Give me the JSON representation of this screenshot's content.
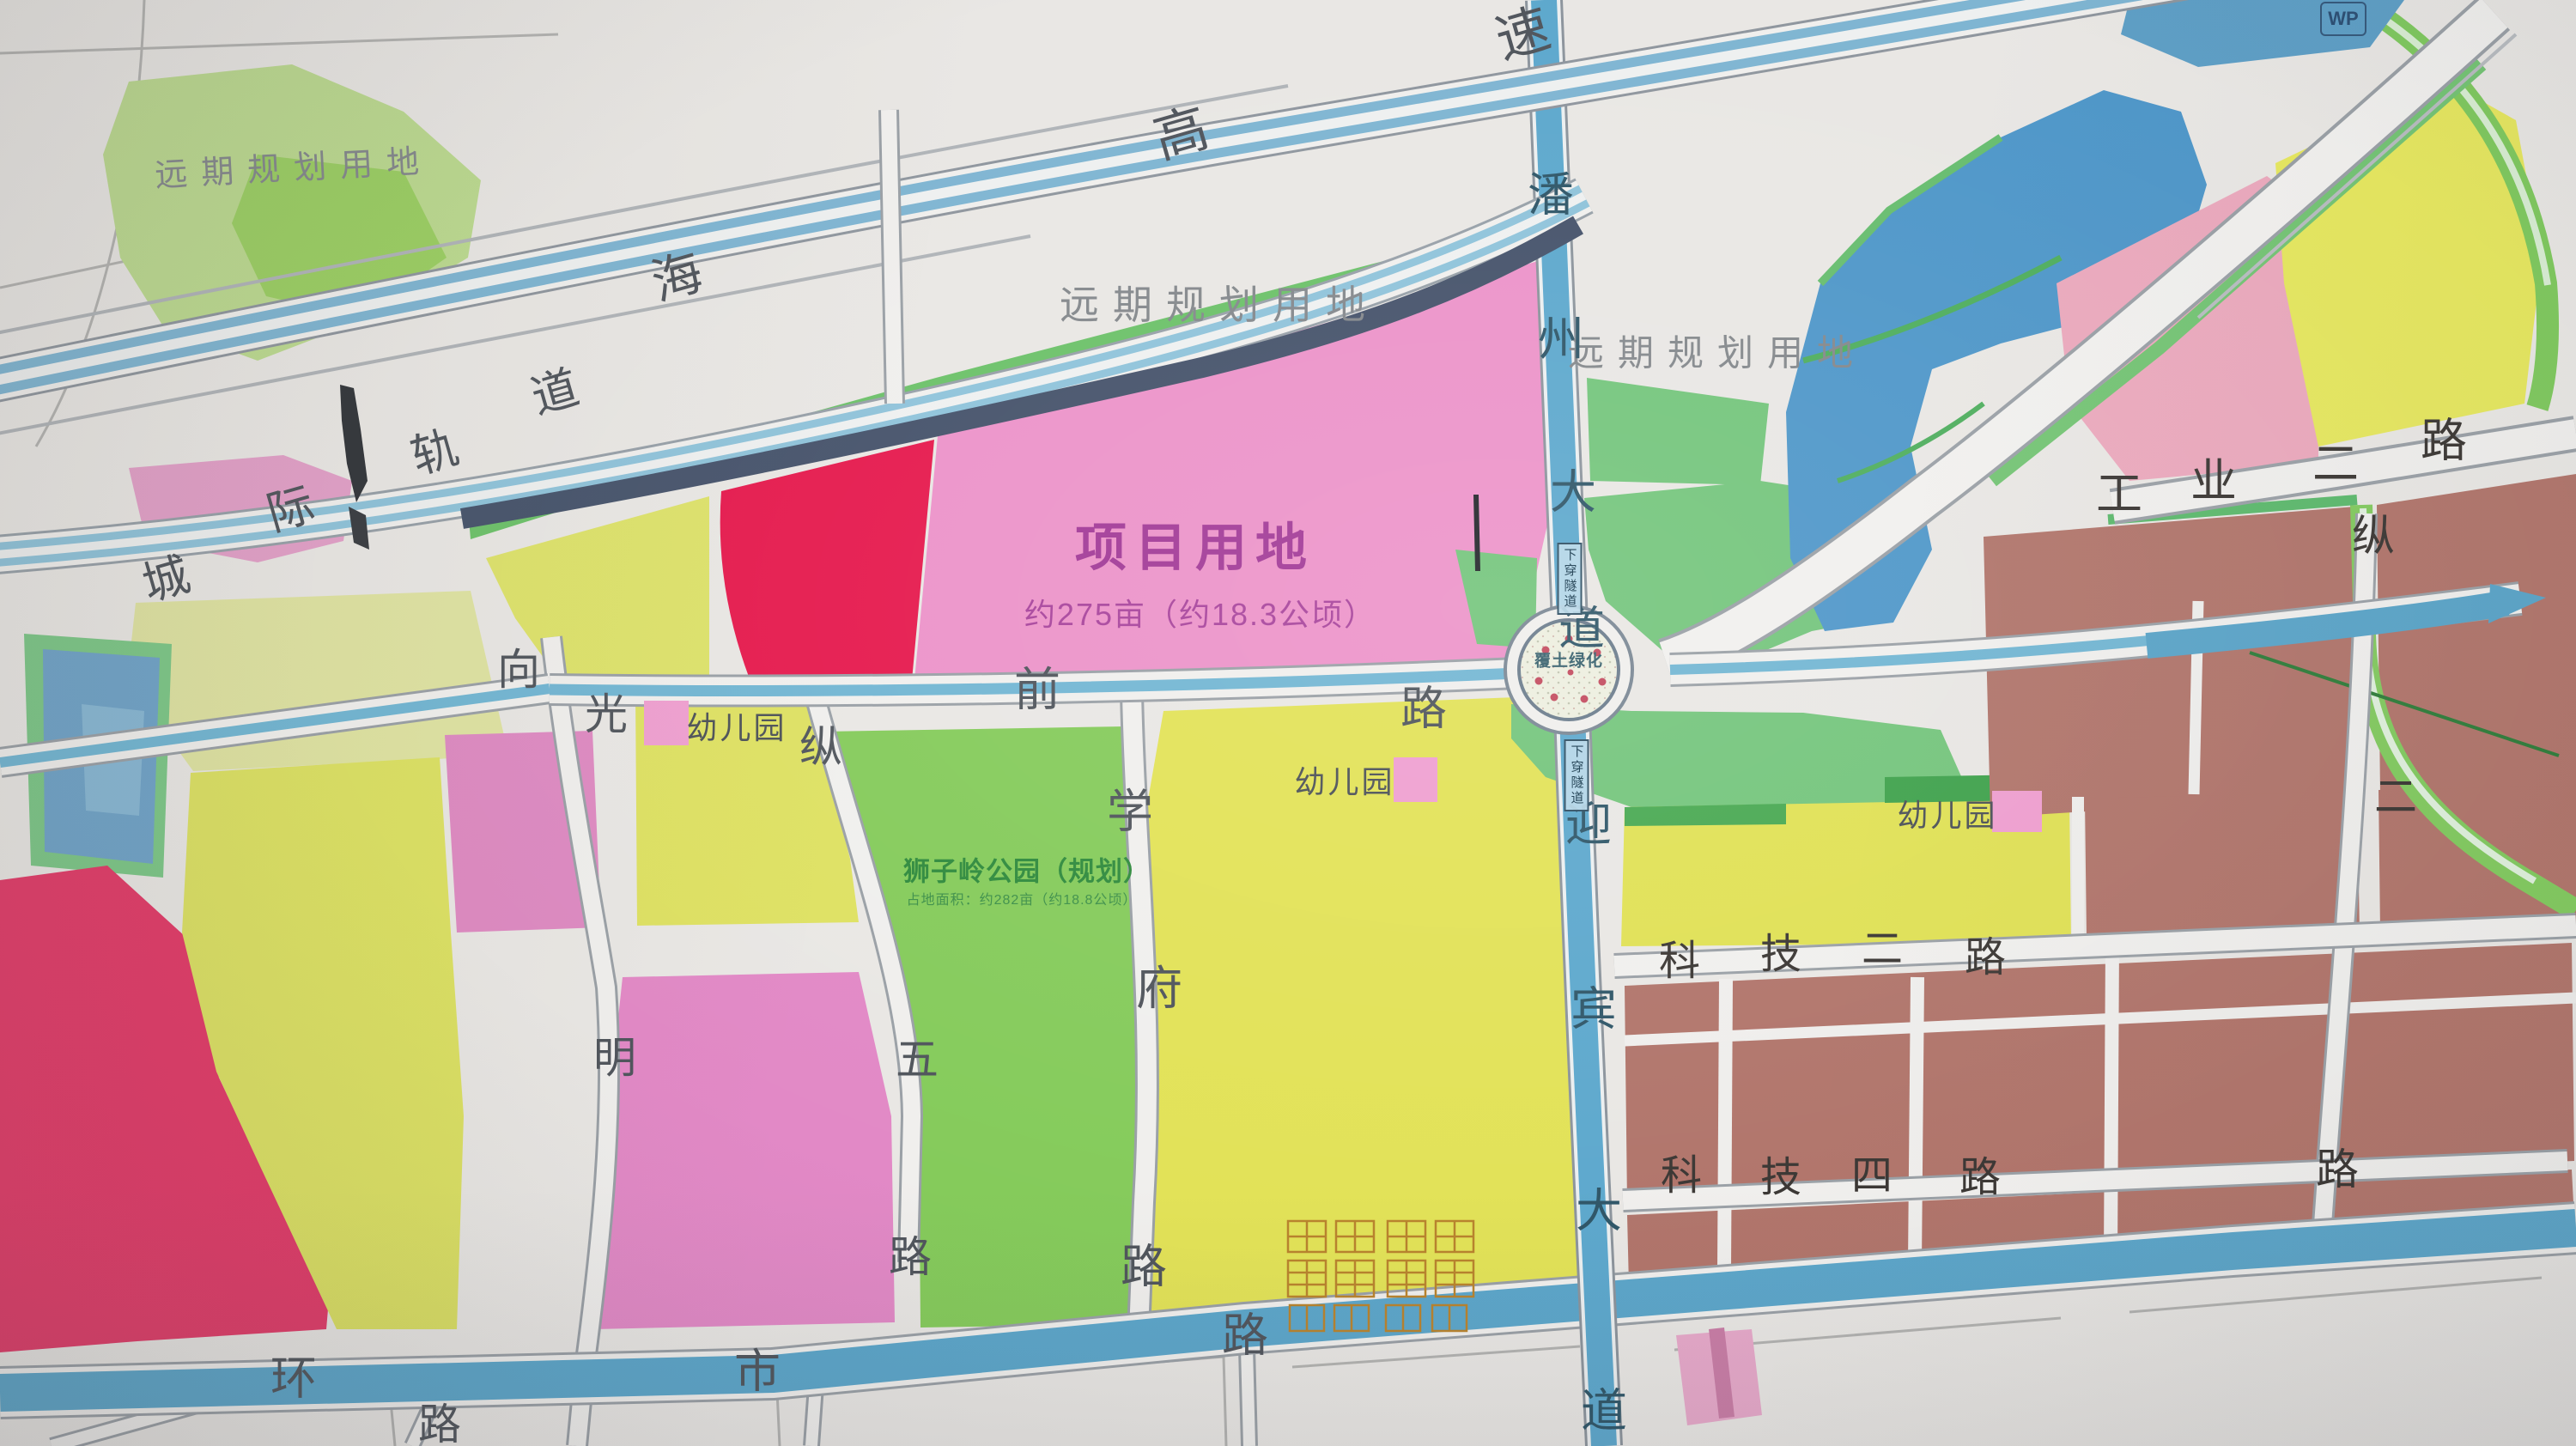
{
  "labels": {
    "future_land": "远期规划用地",
    "project_title": "项目用地",
    "project_area": "约275亩（约18.3公顷）",
    "park_title": "狮子岭公园（规划）",
    "park_area": "占地面积：约282亩（约18.8公顷）",
    "kindergarten": "幼儿园",
    "roundabout_center": "覆土绿化",
    "tunnel": "下穿隧道",
    "badge": "WP"
  },
  "roads": {
    "expressway": "海高速",
    "rail": "城际轨道",
    "panzhou": "潘州大道",
    "yingbin": "迎宾大道",
    "qian": "前路",
    "xiangguangming": "向光明",
    "zongwu": "纵五路",
    "xuefu": "学府路",
    "gongye2": "工业二路",
    "zong2": "纵二路",
    "keji2": "科技二路",
    "keji4": "科技四路",
    "huanshi": "环市路",
    "unnamed": "路"
  },
  "zone_colors": {
    "project_magenta": "#ec93c9",
    "residential_yellow": "#e2e257",
    "industry_brown": "#b1756b",
    "park_green": "#85cb5b",
    "interchange_green": "#74c57c",
    "water_blue": "#4f97c9",
    "road_water_blue": "#5ca6ca",
    "future_crimson": "#e61a4e",
    "pink_parcel": "#e289c6",
    "rail_navy": "#46536b"
  }
}
